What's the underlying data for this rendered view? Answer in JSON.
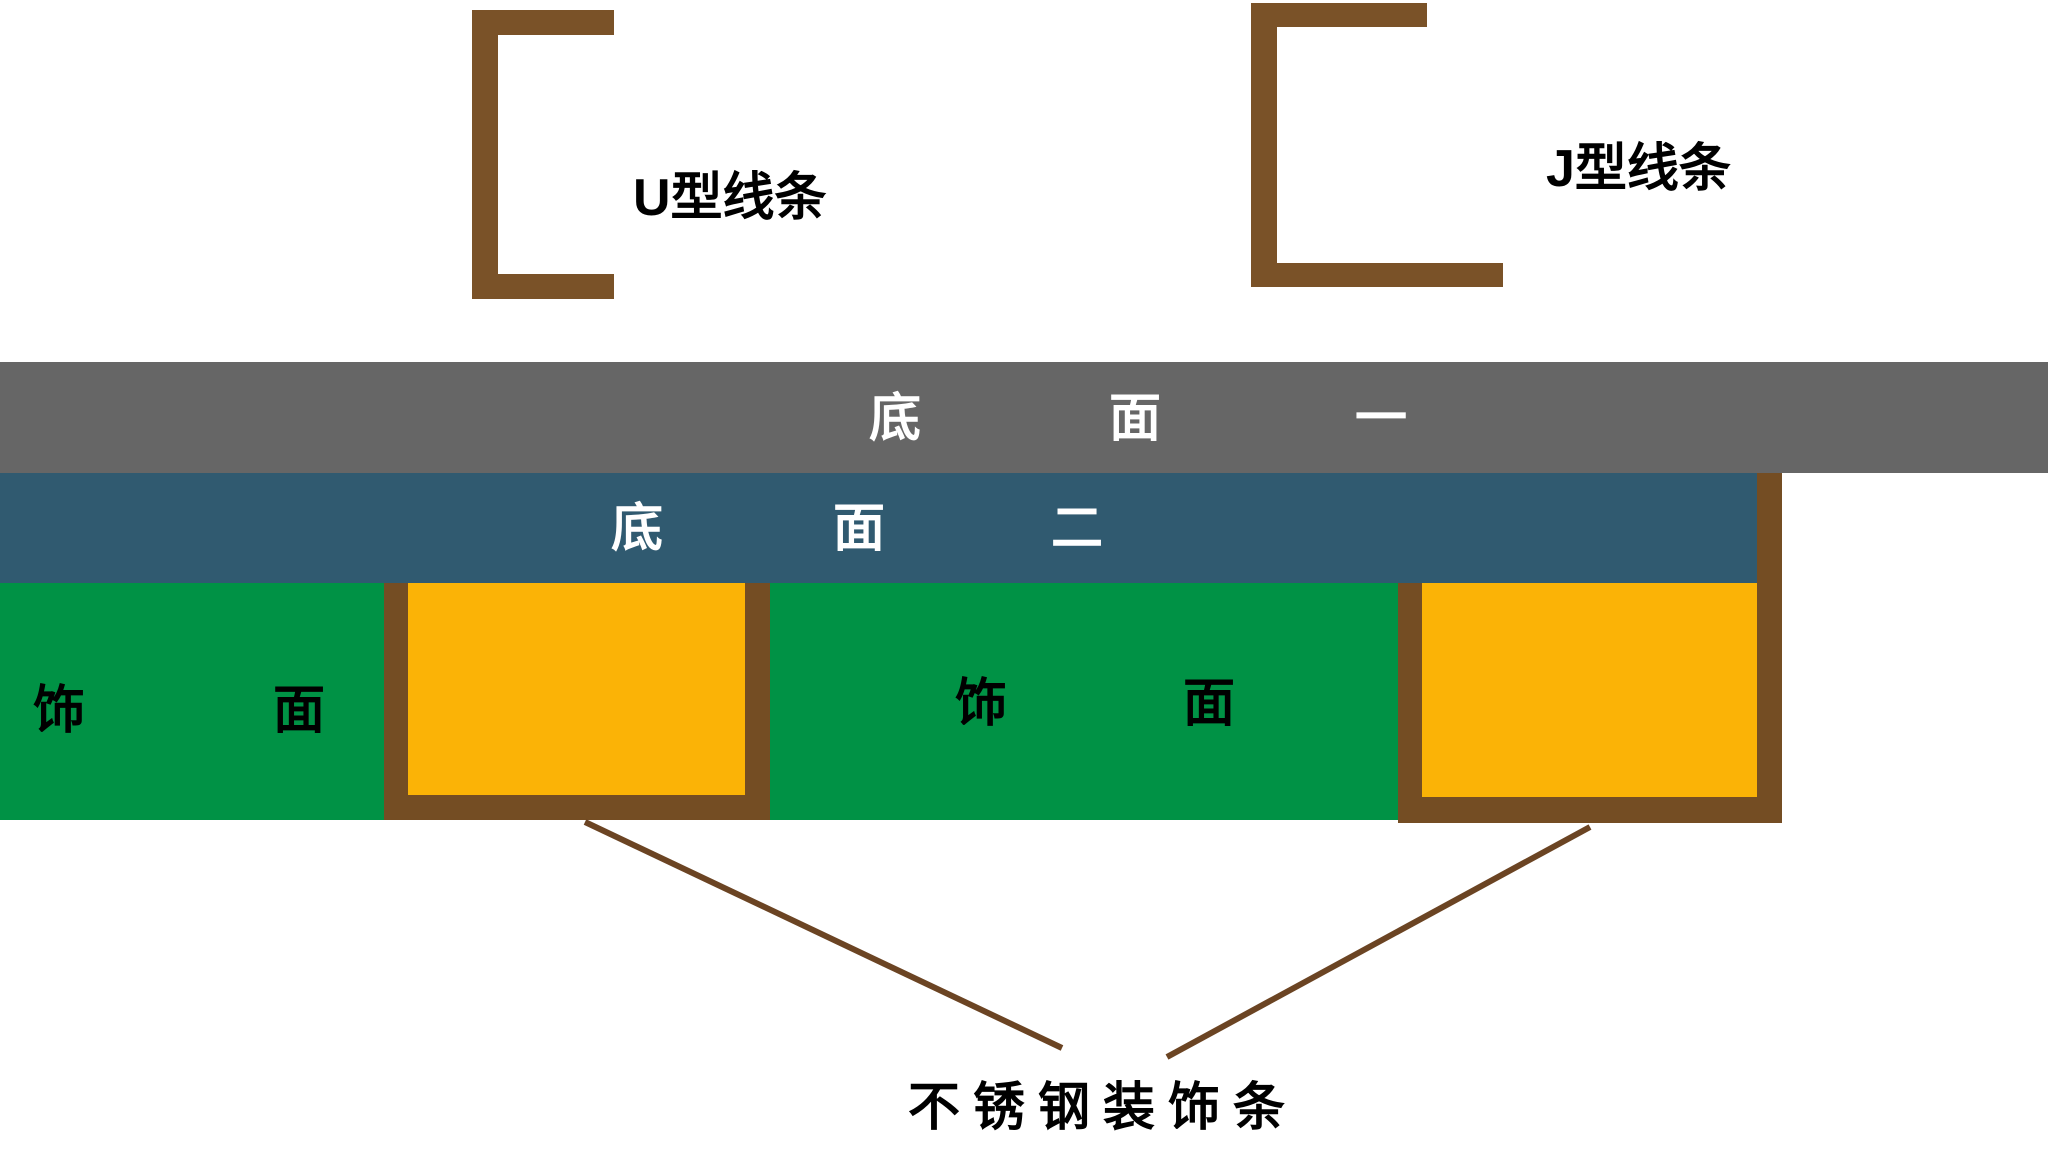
{
  "colors": {
    "background": "#ffffff",
    "gray_bar": "#666666",
    "teal_bar": "#305a70",
    "green": "#009245",
    "orange": "#fbb306",
    "brown": "#7a5228",
    "frame_brown": "#744d23",
    "callout_line": "#6b4423",
    "bar_text": "#ffffff",
    "label_text": "#000000"
  },
  "profiles": {
    "u_label": "U型线条",
    "j_label": "J型线条"
  },
  "bars": {
    "base1": {
      "chars": [
        "底",
        "面",
        "一"
      ]
    },
    "base2": {
      "chars": [
        "底",
        "面",
        "二"
      ]
    }
  },
  "finish": {
    "left": {
      "chars": [
        "饰",
        "面"
      ]
    },
    "mid": {
      "chars": [
        "饰",
        "面"
      ]
    }
  },
  "callout": {
    "label": "不锈钢装饰条"
  }
}
